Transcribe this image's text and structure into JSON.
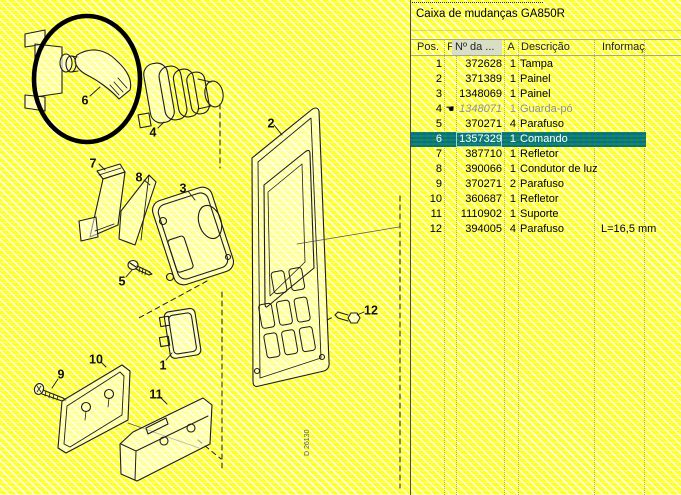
{
  "panel": {
    "title": "Caixa de mudanças GA850R",
    "table": {
      "columns": [
        {
          "key": "pos",
          "label": "Pos."
        },
        {
          "key": "flag",
          "label": "F"
        },
        {
          "key": "part",
          "label": "Nº da ...",
          "highlighted": true
        },
        {
          "key": "qty",
          "label": "A"
        },
        {
          "key": "desc",
          "label": "Descrição"
        },
        {
          "key": "info",
          "label": "Informaç..."
        }
      ],
      "rows": [
        {
          "pos": "1",
          "part": "372628",
          "qty": "1",
          "desc": "Tampa",
          "info": "",
          "state": "normal"
        },
        {
          "pos": "2",
          "part": "371389",
          "qty": "1",
          "desc": "Painel",
          "info": "",
          "state": "normal"
        },
        {
          "pos": "3",
          "part": "1348069",
          "qty": "1",
          "desc": "Painel",
          "info": "",
          "state": "normal"
        },
        {
          "pos": "4",
          "part": "1348071",
          "qty": "1",
          "desc": "Guarda-pó",
          "info": "",
          "state": "disabled",
          "icon": "hand-note"
        },
        {
          "pos": "5",
          "part": "370271",
          "qty": "4",
          "desc": "Parafuso",
          "info": "",
          "state": "normal"
        },
        {
          "pos": "6",
          "part": "1357329",
          "qty": "1",
          "desc": "Comando",
          "info": "",
          "state": "selected"
        },
        {
          "pos": "7",
          "part": "387710",
          "qty": "1",
          "desc": "Refletor",
          "info": "",
          "state": "normal"
        },
        {
          "pos": "8",
          "part": "390066",
          "qty": "1",
          "desc": "Condutor de luz",
          "info": "",
          "state": "normal"
        },
        {
          "pos": "9",
          "part": "370271",
          "qty": "2",
          "desc": "Parafuso",
          "info": "",
          "state": "normal"
        },
        {
          "pos": "10",
          "part": "360687",
          "qty": "1",
          "desc": "Refletor",
          "info": "",
          "state": "normal"
        },
        {
          "pos": "11",
          "part": "1110902",
          "qty": "1",
          "desc": "Suporte",
          "info": "",
          "state": "normal"
        },
        {
          "pos": "12",
          "part": "394005",
          "qty": "4",
          "desc": "Parafuso",
          "info": "L=16,5 mm",
          "state": "normal"
        }
      ]
    }
  },
  "icons": {
    "hand-note": "☚"
  },
  "diagram": {
    "drawing_number": "D 26130",
    "highlighted_part": "6",
    "callouts": [
      {
        "label": "6",
        "x": 85,
        "y": 101
      },
      {
        "label": "4",
        "x": 153,
        "y": 133
      },
      {
        "label": "7",
        "x": 93,
        "y": 164
      },
      {
        "label": "8",
        "x": 139,
        "y": 178
      },
      {
        "label": "3",
        "x": 183,
        "y": 189
      },
      {
        "label": "2",
        "x": 271,
        "y": 124
      },
      {
        "label": "5",
        "x": 122,
        "y": 282
      },
      {
        "label": "12",
        "x": 371,
        "y": 311
      },
      {
        "label": "1",
        "x": 163,
        "y": 366
      },
      {
        "label": "9",
        "x": 61,
        "y": 375
      },
      {
        "label": "10",
        "x": 96,
        "y": 360
      },
      {
        "label": "11",
        "x": 156,
        "y": 395
      }
    ]
  },
  "colors": {
    "background_yellow": "#ffff2e",
    "selection_teal": "#0c7f95",
    "selection_green": "#168a5f",
    "selected_text": "#ffffff",
    "disabled_text": "#8f8f8f",
    "header_highlight": "#d9dfc6",
    "panel_divider": "#4a4a4a"
  }
}
